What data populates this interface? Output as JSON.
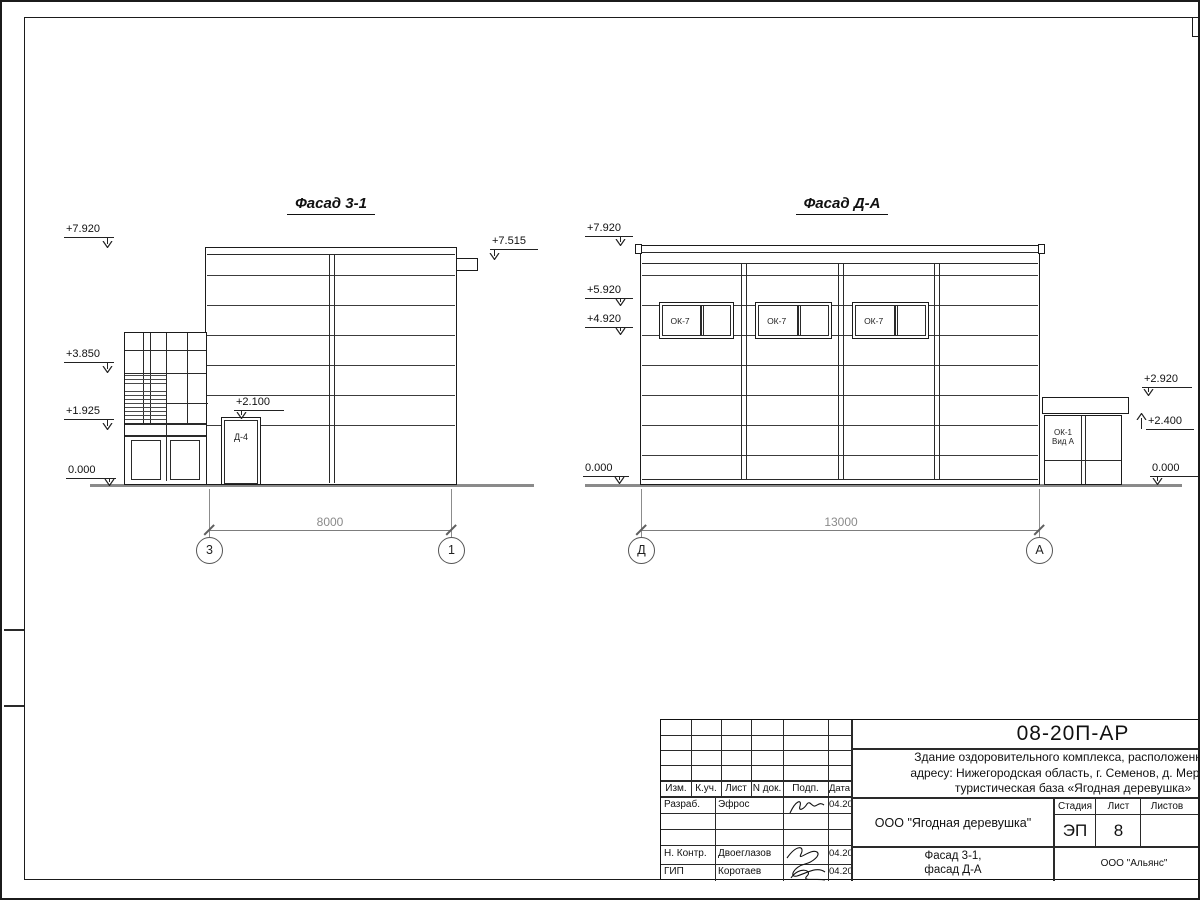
{
  "sheet": {
    "code": "08-20П-АР",
    "project_lines": [
      "Здание оздоровительного комплекса, расположенное по",
      "адресу: Нижегородская область, г. Семенов, д. Мериново,",
      "туристическая база «Ягодная деревушка»"
    ]
  },
  "facade_left": {
    "title": "Фасад 3-1",
    "door_label": "Д-4",
    "dimension": "8000",
    "axes": {
      "left": "3",
      "right": "1"
    },
    "elevations": {
      "roof": "+7.920",
      "scupper": "+7.515",
      "mid": "+3.850",
      "low": "+1.925",
      "ground": "0.000",
      "door": "+2.100"
    }
  },
  "facade_right": {
    "title": "Фасад Д-А",
    "dimension": "13000",
    "axes": {
      "left": "Д",
      "right": "А"
    },
    "windows": [
      "ОК-7",
      "ОК-7",
      "ОК-7"
    ],
    "annex_window": {
      "line1": "ОК-1",
      "line2": "Вид А"
    },
    "elevations": {
      "roof": "+7.920",
      "upper": "+5.920",
      "window": "+4.920",
      "ground_left": "0.000",
      "annex_roof": "+2.920",
      "annex_top": "+2.400",
      "ground_right": "0.000"
    }
  },
  "title_block": {
    "headers": [
      "Изм.",
      "К.уч.",
      "Лист",
      "N док.",
      "Подп.",
      "Дата"
    ],
    "rows": [
      {
        "role": "Разраб.",
        "name": "Эфрос",
        "date": "04.20"
      },
      {
        "role": "",
        "name": "",
        "date": ""
      },
      {
        "role": "",
        "name": "",
        "date": ""
      },
      {
        "role": "Н. Контр.",
        "name": "Двоеглазов",
        "date": "04.20"
      },
      {
        "role": "ГИП",
        "name": "Коротаев",
        "date": "04.20"
      }
    ],
    "org": "ООО \"Ягодная деревушка\"",
    "stage_label": "Стадия",
    "sheet_label": "Лист",
    "sheets_label": "Листов",
    "stage": "ЭП",
    "sheet_number": "8",
    "drawing_title_line1": "Фасад 3-1,",
    "drawing_title_line2": "фасад Д-А",
    "contractor": "ООО \"Альянс\""
  }
}
